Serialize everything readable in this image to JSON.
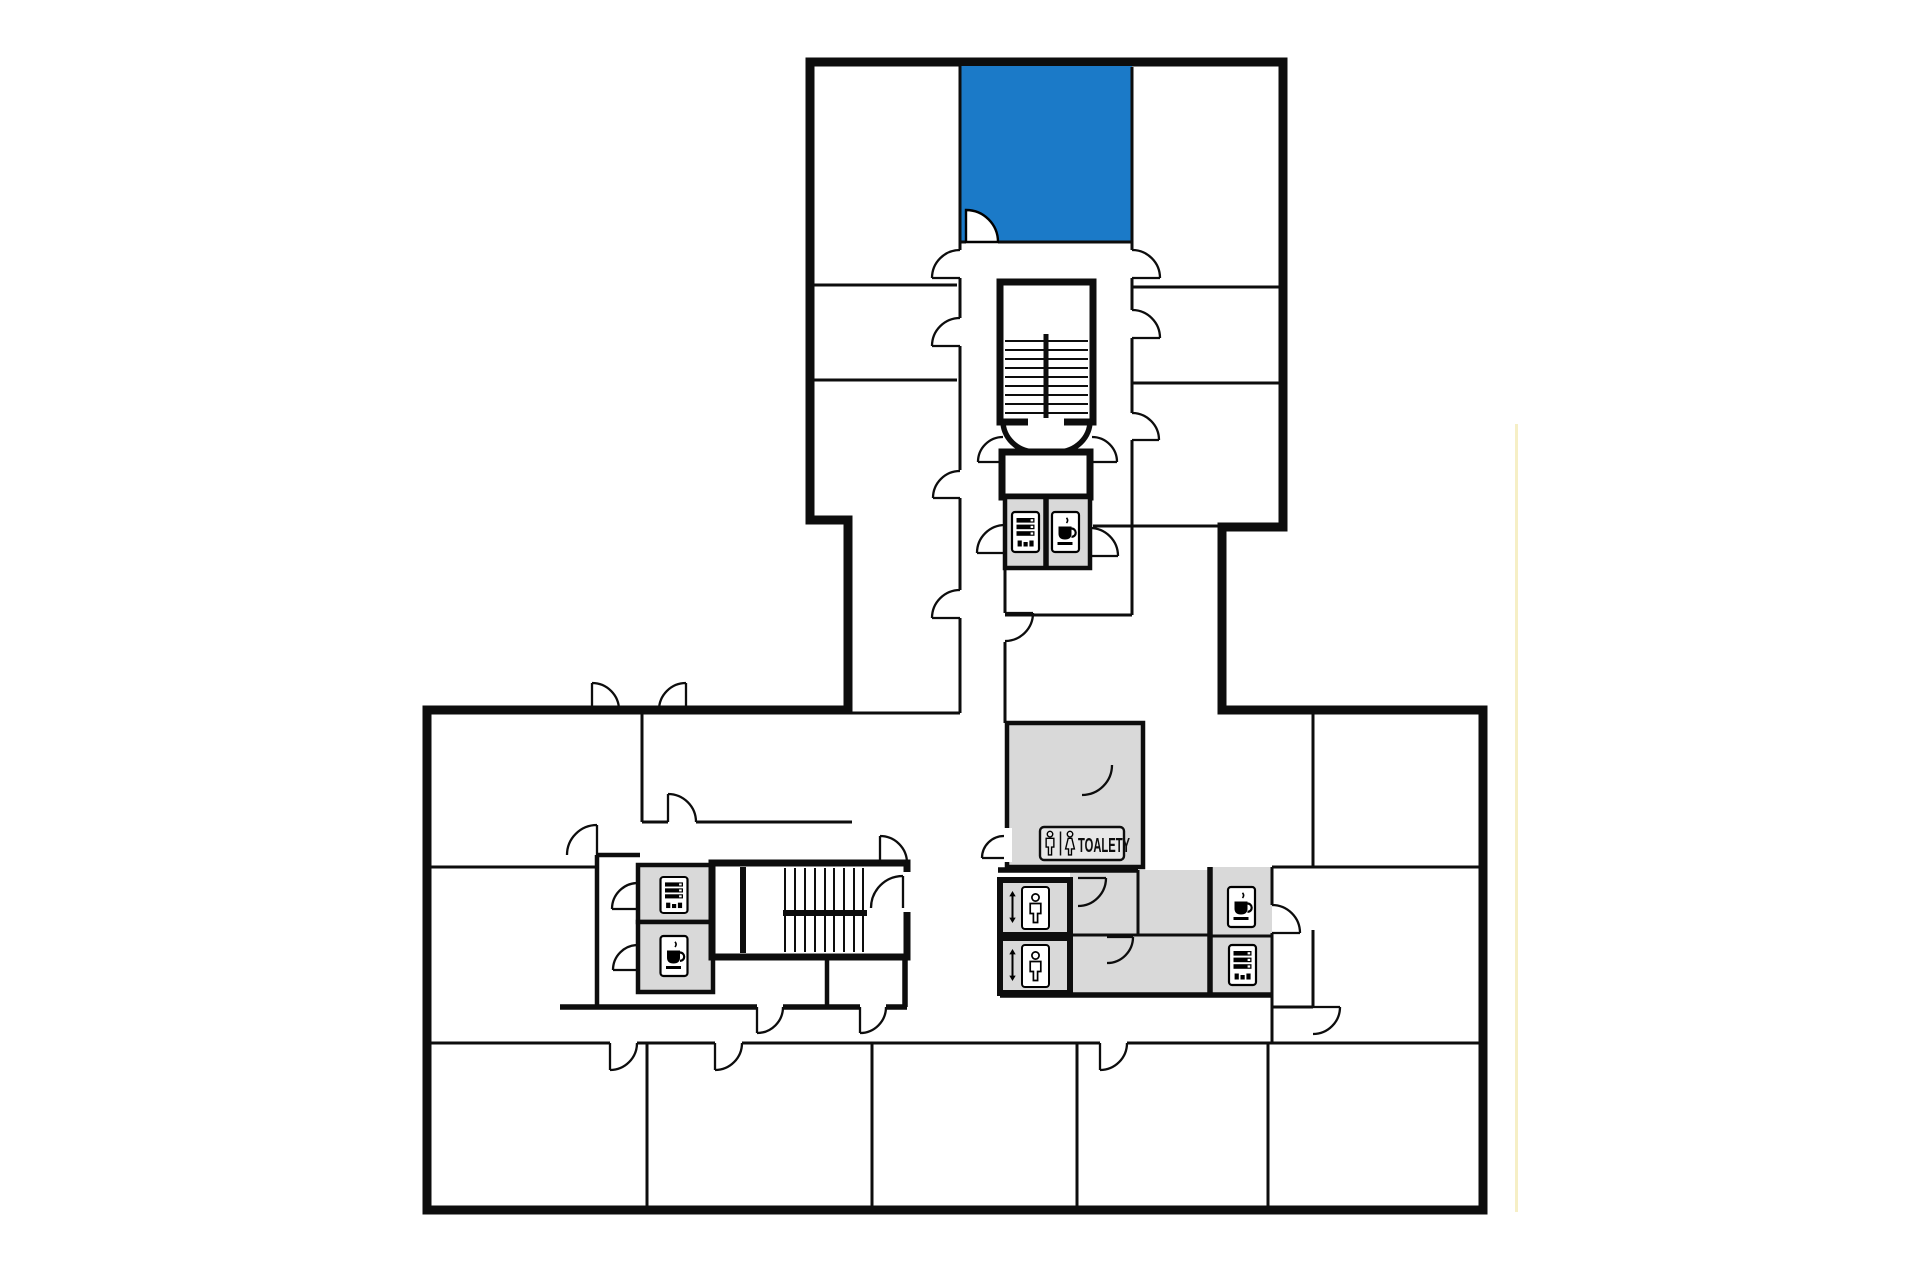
{
  "colors": {
    "highlight": "#1b7ac8",
    "service_area": "#d9d9d9",
    "wall": "#0d0d0d",
    "background": "#ffffff",
    "sign_fill": "#e8e8e8",
    "edge_artifact": "#f5ecbc"
  },
  "toilets_sign": {
    "label": "TOALETY",
    "icons": [
      "man-icon",
      "woman-icon"
    ]
  },
  "icons": {
    "vending": "vending-machine-icon",
    "coffee": "coffee-machine-icon",
    "elevator": "elevator-icon"
  },
  "highlighted_room": {
    "status": "highlighted"
  }
}
